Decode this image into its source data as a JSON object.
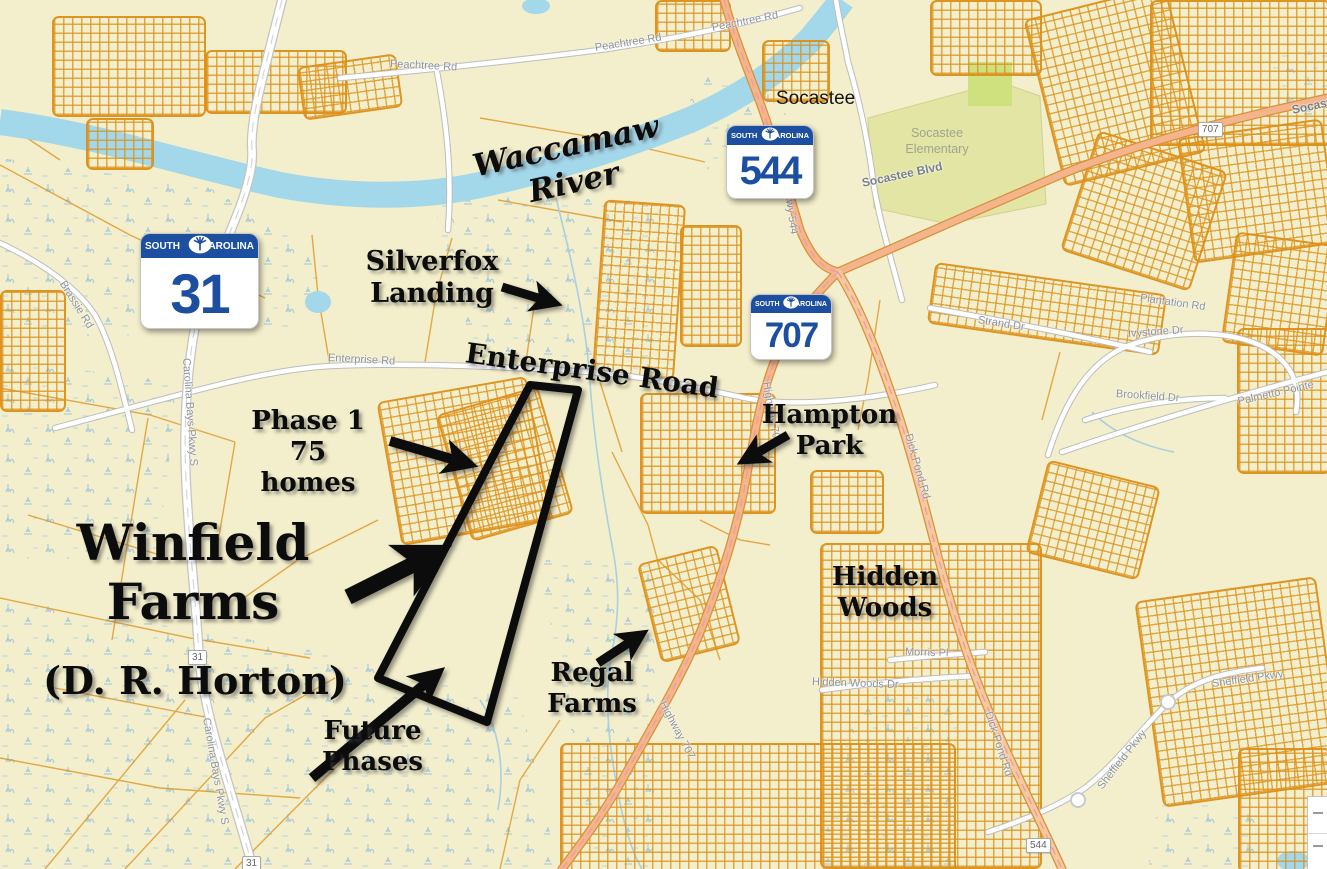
{
  "colors": {
    "map_background": "#f3eecb",
    "parcel_orange": "#dd9018",
    "river_blue": "#a3d7ea",
    "highway_salmon": "#f4b48c",
    "shield_blue": "#1d4fa1",
    "annotation_black": "#0c0c0c",
    "green_area": "#e2e5a4"
  },
  "annotations": {
    "river": "Waccamaw River",
    "silverfox": [
      "Silverfox",
      "Landing"
    ],
    "enterprise_road": "Enterprise Road",
    "phase1": [
      "Phase 1",
      "75 homes"
    ],
    "winfield": [
      "Winfield",
      "Farms"
    ],
    "developer": "(D. R. Horton)",
    "future": [
      "Future",
      "Phases"
    ],
    "regal": [
      "Regal",
      "Farms"
    ],
    "hampton": [
      "Hampton",
      "Park"
    ],
    "hidden": [
      "Hidden",
      "Woods"
    ]
  },
  "shields": {
    "sc31": {
      "left": "SOUTH",
      "right": "CAROLINA",
      "number": "31"
    },
    "sc544": {
      "left": "SOUTH",
      "right": "CAROLINA",
      "number": "544"
    },
    "sc707": {
      "left": "SOUTH",
      "right": "CAROLINA",
      "number": "707"
    }
  },
  "route_markers": {
    "m31a": "31",
    "m31b": "31",
    "m544": "544",
    "m707": "707"
  },
  "places": {
    "socastee": "Socastee",
    "socastee_elementary": [
      "Socastee",
      "Elementary"
    ]
  },
  "streets": {
    "peachtree_a": "Peachtree Rd",
    "peachtree_b": "Peachtree Rd",
    "peachtree_c": "Peachtree Rd",
    "brassie": "Brassie Rd",
    "carolina_bays_a": "Carolina Bays Pkwy S",
    "carolina_bays_b": "Carolina Bays Pkwy S",
    "enterprise": "Enterprise Rd",
    "socastee_blvd_a": "Socastee Blvd",
    "socastee_blvd_b": "Socastee Blvd",
    "hwy544": "Hwy 544",
    "hwy707_a": "Highway 707",
    "hwy707_b": "Highway 707",
    "dick_pond_a": "Dick Pond Rd",
    "dick_pond_b": "Dick Pond Rd",
    "strand": "Strand Dr",
    "plantation": "Plantation Rd",
    "ivystone": "Ivystone Dr",
    "brookfield": "Brookfield Dr",
    "palmetto_pointe": "Palmetto Pointe",
    "sheffield_a": "Sheffield Pkwy",
    "sheffield_b": "Sheffield Pkwy",
    "morris": "Morris Pl",
    "hidden_woods_dr": "Hidden Woods Dr"
  }
}
